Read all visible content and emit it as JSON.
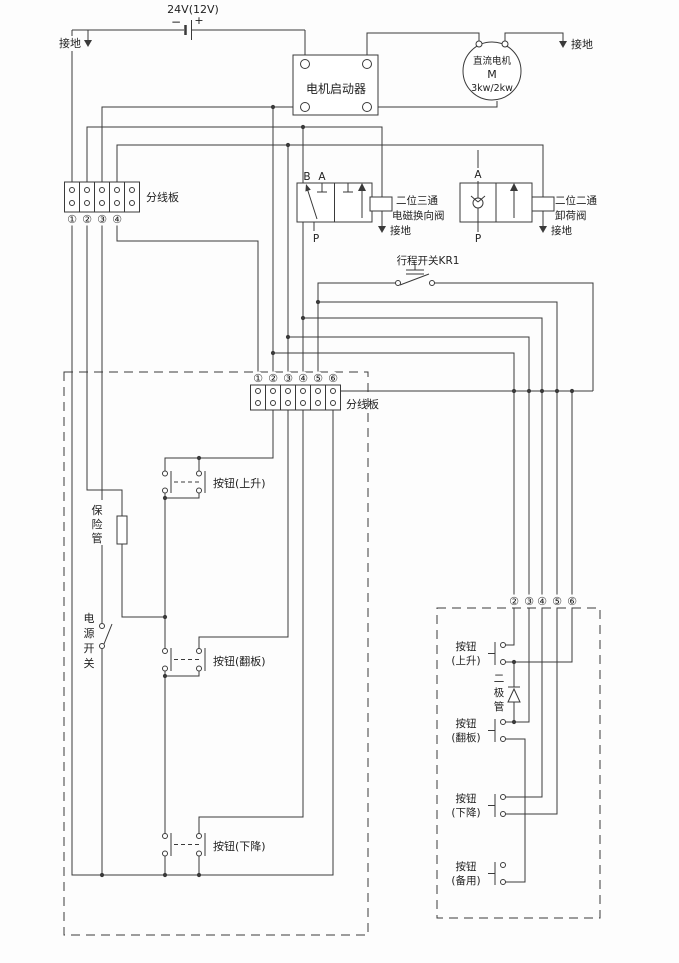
{
  "power": {
    "label": "24V(12V)",
    "minus": "−",
    "plus": "+",
    "ground_label": "接地"
  },
  "starter": {
    "label": "电机启动器"
  },
  "motor": {
    "name": "直流电机",
    "symbol": "M",
    "rating": "3kw/2kw",
    "ground_label": "接地"
  },
  "left_board": {
    "label": "分线板",
    "terminals": [
      "①",
      "②",
      "③",
      "④"
    ]
  },
  "valve_3way": {
    "port_b": "B",
    "port_a": "A",
    "port_p": "P",
    "name1": "二位三通",
    "name2": "电磁换向阀",
    "ground_label": "接地"
  },
  "valve_2way": {
    "port_a": "A",
    "port_p": "P",
    "name1": "二位二通",
    "name2": "卸荷阀",
    "ground_label": "接地"
  },
  "limit_switch": {
    "label": "行程开关KR1"
  },
  "center_board": {
    "label": "分线板",
    "terminals": [
      "①",
      "②",
      "③",
      "④",
      "⑤",
      "⑥"
    ]
  },
  "left_panel": {
    "fuse_chars": [
      "保",
      "险",
      "管"
    ],
    "switch_chars": [
      "电",
      "源",
      "开",
      "关"
    ],
    "button_up": "按钮(上升)",
    "button_flip": "按钮(翻板)",
    "button_down": "按钮(下降)"
  },
  "right_panel": {
    "terminals": [
      "②",
      "③",
      "④",
      "⑤",
      "⑥"
    ],
    "diode_chars": [
      "二",
      "极",
      "管"
    ],
    "button_up_l1": "按钮",
    "button_up_l2": "(上升)",
    "button_flip_l1": "按钮",
    "button_flip_l2": "(翻板)",
    "button_down_l1": "按钮",
    "button_down_l2": "(下降)",
    "button_spare_l1": "按钮",
    "button_spare_l2": "(备用)"
  }
}
